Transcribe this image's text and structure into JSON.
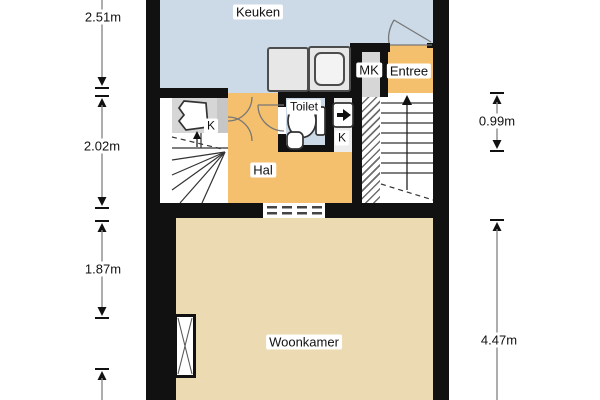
{
  "rooms": {
    "keuken": {
      "label": "Keuken"
    },
    "mk": {
      "label": "MK"
    },
    "entree": {
      "label": "Entree"
    },
    "toilet": {
      "label": "Toilet"
    },
    "closet_left": {
      "label": "K"
    },
    "closet_right": {
      "label": "K"
    },
    "hal": {
      "label": "Hal"
    },
    "woonkamer": {
      "label": "Woonkamer"
    }
  },
  "measurements": {
    "left_top": "2.51m",
    "left_middle": "2.02m",
    "left_lower": "1.87m",
    "right_top": "0.99m",
    "right_bottom": "4.47m"
  },
  "colors": {
    "wall": "#111111",
    "keuken_blue": "#ccdae7",
    "hal_orange": "#f5c06d",
    "woonkamer_beige": "#ecdbb2",
    "closet_gray": "#d6d6d6",
    "stair_line": "#333333",
    "dimension_line": "#8a8a8a"
  }
}
